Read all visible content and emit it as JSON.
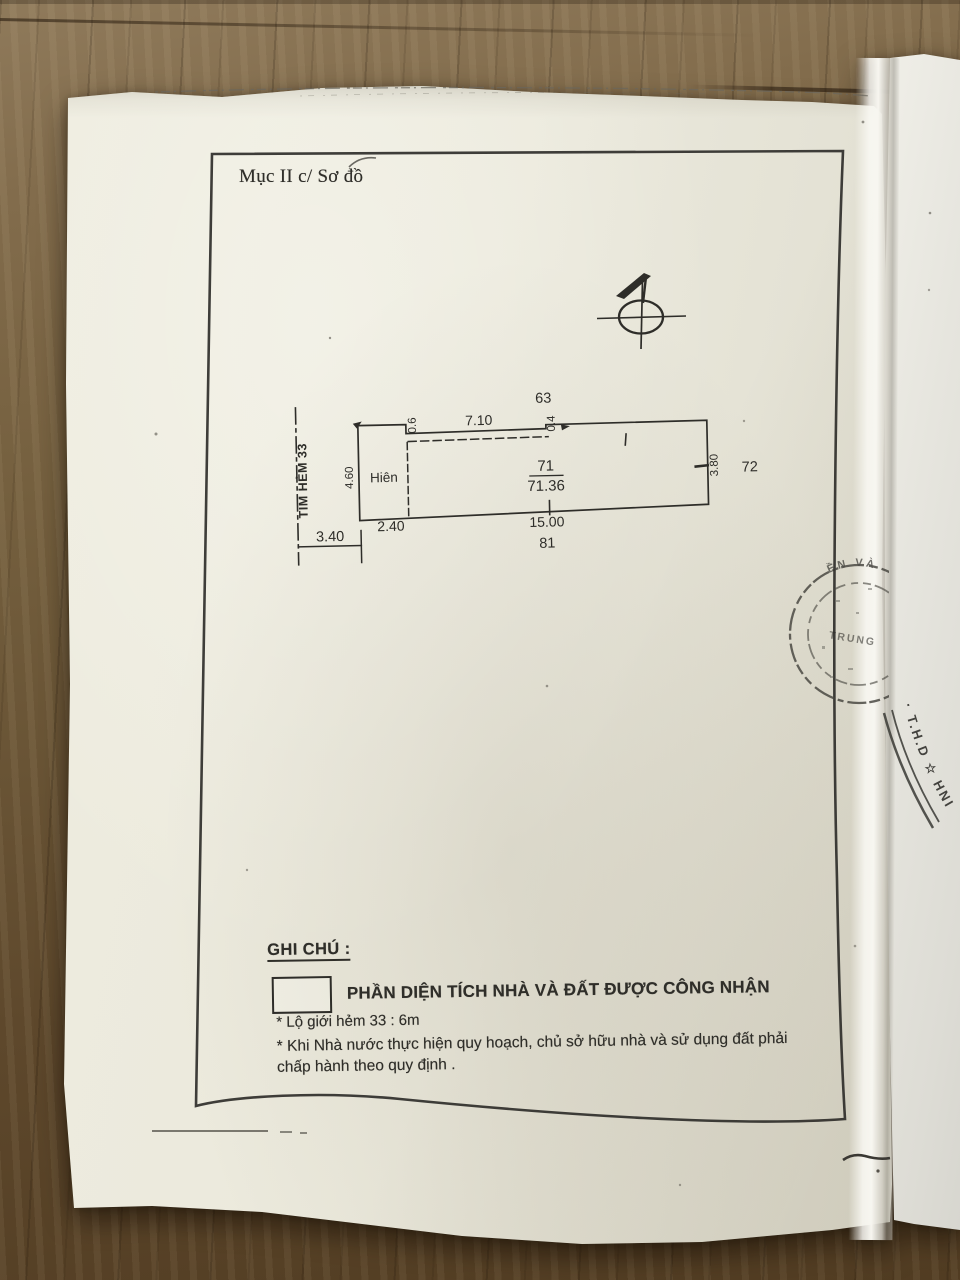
{
  "page": {
    "section_label": "Mục II c/ Sơ đồ"
  },
  "diagram": {
    "north_icon": "north-arrow",
    "alley_centerline_label": "TIM HẺM 33",
    "porch_label": "Hiên",
    "dims": {
      "alley_half_width": "3.40",
      "porch_width": "2.40",
      "porch_depth": "4.60",
      "step_left": "0.6",
      "front_top": "7.10",
      "step_right": "0.4",
      "right_depth": "3.80",
      "bottom_length": "15.00"
    },
    "parcels": {
      "top": "63",
      "right": "72",
      "bottom": "81",
      "number": "71",
      "area": "71.36"
    }
  },
  "legend": {
    "heading": "GHI CHÚ :",
    "swatch_caption": "PHẦN DIỆN TÍCH NHÀ VÀ ĐẤT ĐƯỢC CÔNG NHẬN",
    "note_road": "* Lộ giới hẻm 33 : 6m",
    "note_planning_1": "* Khi Nhà nước thực hiện quy hoạch, chủ sở hữu nhà và sử dụng đất phải",
    "note_planning_2": "chấp hành theo quy định ."
  },
  "stamps": {
    "upper_fragment_arc": "ỀN VÀ",
    "upper_fragment_center": "TRUNG",
    "lower_arc_text": "· T.H.D ☆ HNIM ·"
  },
  "colors": {
    "ink": "#2e2d29",
    "paper": "#ebe9dd",
    "wood": "#6e5839",
    "stamp_ink": "#45443e"
  }
}
